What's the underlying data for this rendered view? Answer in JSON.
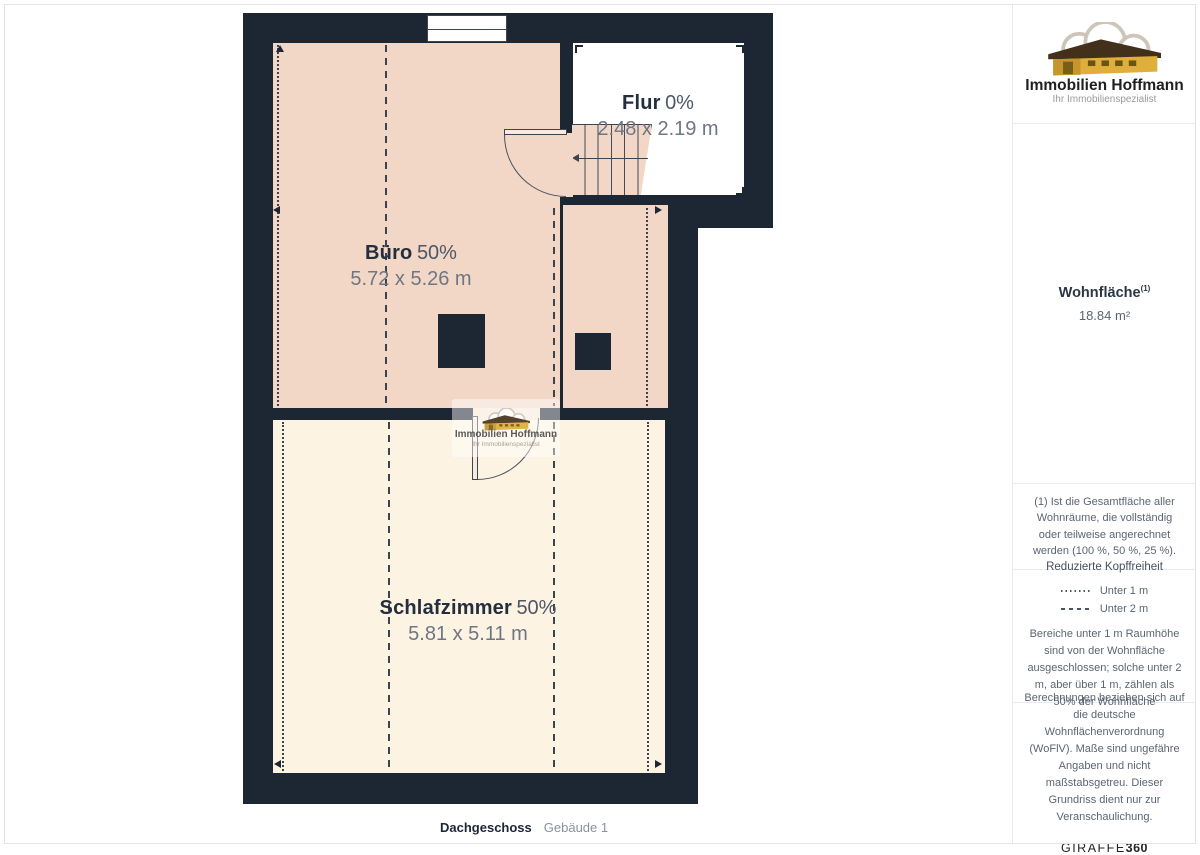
{
  "brand": {
    "name": "Immobilien Hoffmann",
    "tagline": "Ihr Immobilienspezialist"
  },
  "floorplan": {
    "floor_label": "Dachgeschoss",
    "building_label": "Gebäude 1",
    "rooms": [
      {
        "id": "flur",
        "name": "Flur",
        "percent": "0%",
        "dims": "2.48 x 2.19 m"
      },
      {
        "id": "buero",
        "name": "Büro",
        "percent": "50%",
        "dims": "5.72 x 5.26 m"
      },
      {
        "id": "schlafzimmer",
        "name": "Schlafzimmer",
        "percent": "50%",
        "dims": "5.81 x 5.11 m"
      }
    ],
    "colors": {
      "wall": "#1d2734",
      "room_50_percent": "#f2d7c7",
      "room_50_percent_alt": "#fdf3e2",
      "room_0_percent": "#ffffff"
    }
  },
  "sidebar": {
    "area": {
      "label": "Wohnfläche",
      "footnote_marker": "(1)",
      "value": "18.84 m²"
    },
    "footnote": "(1) Ist die Gesamtfläche aller Wohnräume, die vollständig oder teilweise angerechnet werden (100 %, 50 %, 25 %).",
    "headroom": {
      "title": "Reduzierte Kopffreiheit",
      "legend": [
        {
          "style": "dotted",
          "label": "Unter 1 m"
        },
        {
          "style": "dashed",
          "label": "Unter 2 m"
        }
      ],
      "note": "Bereiche unter 1 m Raumhöhe sind von der Wohnfläche ausgeschlossen; solche unter 2 m, aber über 1 m, zählen als 50% der Wohnfläche"
    },
    "disclaimer": "Berechnungen beziehen sich auf die deutsche Wohnflächenverordnung (WoFlV). Maße sind ungefähre Angaben und nicht maßstabsgetreu. Dieser Grundriss dient nur zur Veranschaulichung.",
    "vendor": {
      "name": "GIRAFFE",
      "suffix": "360"
    }
  }
}
